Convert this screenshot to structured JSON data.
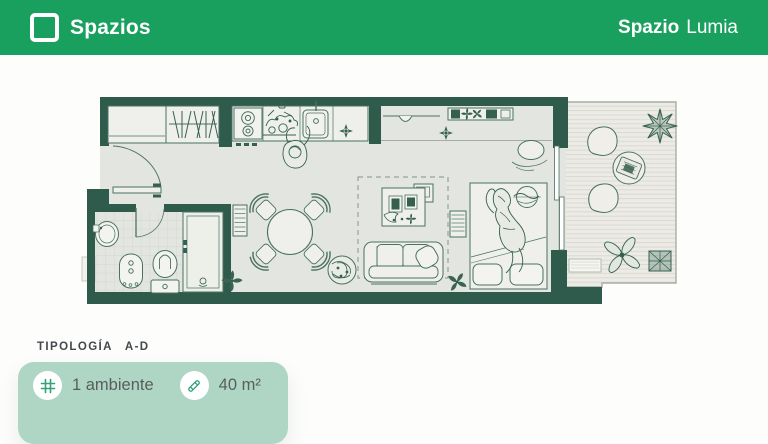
{
  "header": {
    "brand": "Spazios",
    "project": {
      "bold": "Spazio",
      "light": "Lumia"
    }
  },
  "typology": {
    "label": "TIPOLOGÍA",
    "value": "A-D"
  },
  "unit_card": {
    "rooms_label": "1 ambiente",
    "area_label": "40 m²",
    "rooms_icon": "grid-hash-icon",
    "area_icon": "ruler-icon"
  },
  "colors": {
    "header_green": "#19A05F",
    "wall_green": "#2E5B4C",
    "sketch_line": "#4A7163",
    "sketch_dark": "#35604F",
    "floor_gray": "#E3E5E0",
    "balcony_floor": "#ECEBE5",
    "card_mint": "#AFD6C4",
    "icon_green": "#33A279",
    "text_dark": "#43484C",
    "text_gray": "#585E60"
  },
  "floor_plan": {
    "type": "studio-apartment-top-view",
    "depicted_elements": [
      "entry-door",
      "closet-with-hangers",
      "kitchen-stove",
      "kitchen-sink",
      "kitchen-counter",
      "person-cooking",
      "desk-with-shelf",
      "desk-chair",
      "bathroom-sink",
      "bathroom-door",
      "bidet",
      "toilet",
      "shower",
      "hall-dresser",
      "dining-table-4-chairs",
      "pouf",
      "rug",
      "coffee-table",
      "sofa-with-pillow",
      "dresser",
      "bed-with-person",
      "sliding-glass-door",
      "balcony-deck",
      "balcony-chairs",
      "balcony-table",
      "balcony-plants",
      "doormat"
    ]
  }
}
